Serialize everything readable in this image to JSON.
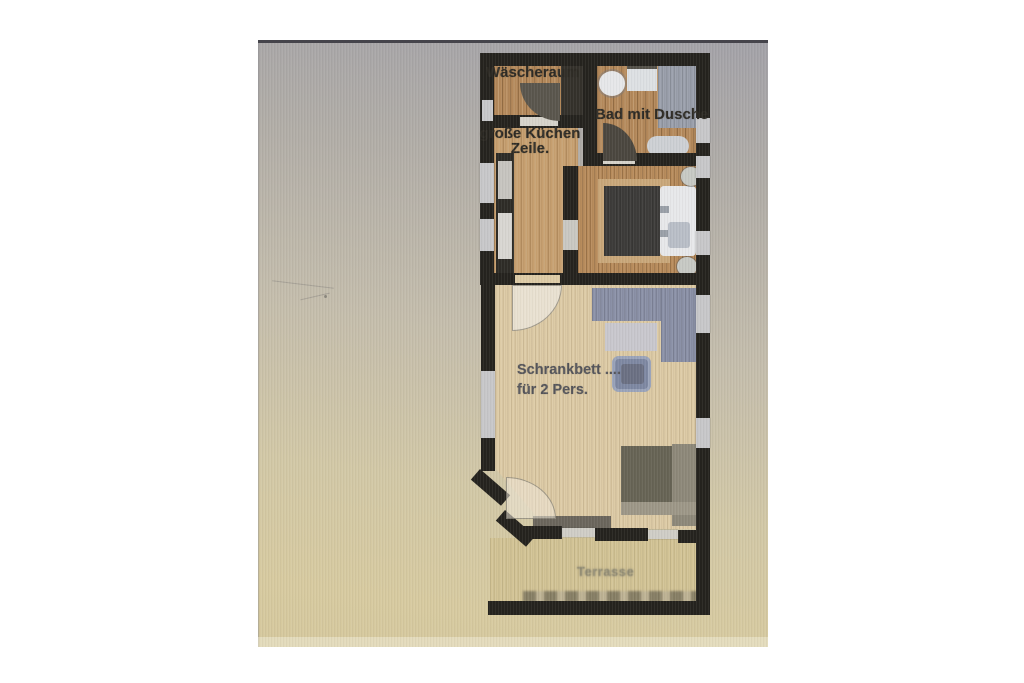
{
  "floor_plan": {
    "labels": {
      "laundry": "Wäscheraum",
      "bathroom": "Bad mit Dusche",
      "kitchen_line1": "große Küchen",
      "kitchen_line2": "Zeile.",
      "living_line1": "Schrankbett ....",
      "living_line2": "für 2 Pers.",
      "terrace": "Terrasse"
    },
    "colors": {
      "wall": "#25231e",
      "wood_floor": "#b3885a",
      "wood_floor_light": "#c59e6e",
      "living_floor": "#ddcba6",
      "terrace_floor": "#d3c496",
      "sofa": "#8b91a7",
      "shower": "#9ba0ac",
      "bed_dark": "#3d3c3a",
      "bed_linen": "#e7e8ea",
      "wardrobe": "#676455",
      "label_dark": "#2e2b25",
      "label_blue_gray": "#55555a",
      "label_terrace": "#8e8973",
      "photo_background_top": "#a3a2a8",
      "photo_background_bottom": "#d5c89d"
    }
  }
}
